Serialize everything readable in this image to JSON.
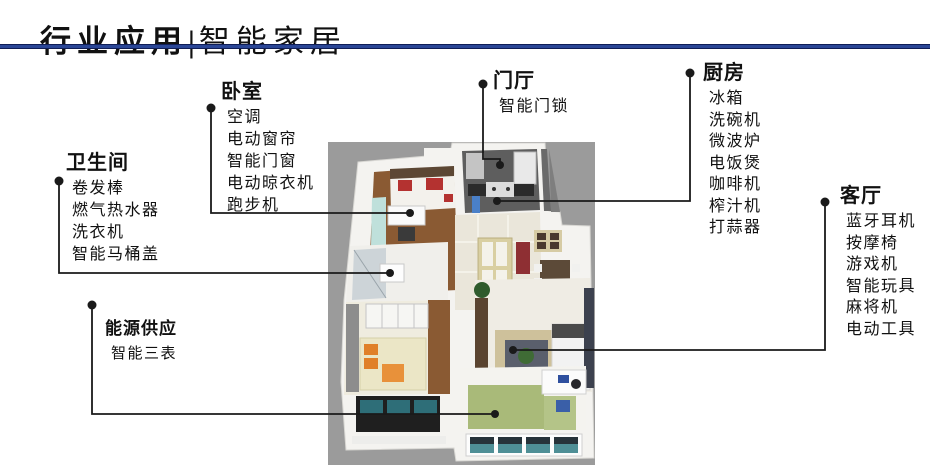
{
  "title": {
    "part1": "行业应用",
    "divider": "|",
    "part2": "智能家居"
  },
  "colors": {
    "title_rule": "#2a4696",
    "connector": "#1a1a1a",
    "floorplan_background": "#9b9b9b"
  },
  "sections": {
    "bathroom": {
      "heading": "卫生间",
      "items": [
        "卷发棒",
        "燃气热水器",
        "洗衣机",
        "智能马桶盖"
      ]
    },
    "bedroom": {
      "heading": "卧室",
      "items": [
        "空调",
        "电动窗帘",
        "智能门窗",
        "电动晾衣机",
        "跑步机"
      ]
    },
    "entrance": {
      "heading": "门厅",
      "items": [
        "智能门锁"
      ]
    },
    "kitchen": {
      "heading": "厨房",
      "items": [
        "冰箱",
        "洗碗机",
        "微波炉",
        "电饭煲",
        "咖啡机",
        "榨汁机",
        "打蒜器"
      ]
    },
    "living": {
      "heading": "客厅",
      "items": [
        "蓝牙耳机",
        "按摩椅",
        "游戏机",
        "智能玩具",
        "麻将机",
        "电动工具"
      ]
    },
    "energy": {
      "heading": "能源供应",
      "items": [
        "智能三表"
      ]
    }
  }
}
